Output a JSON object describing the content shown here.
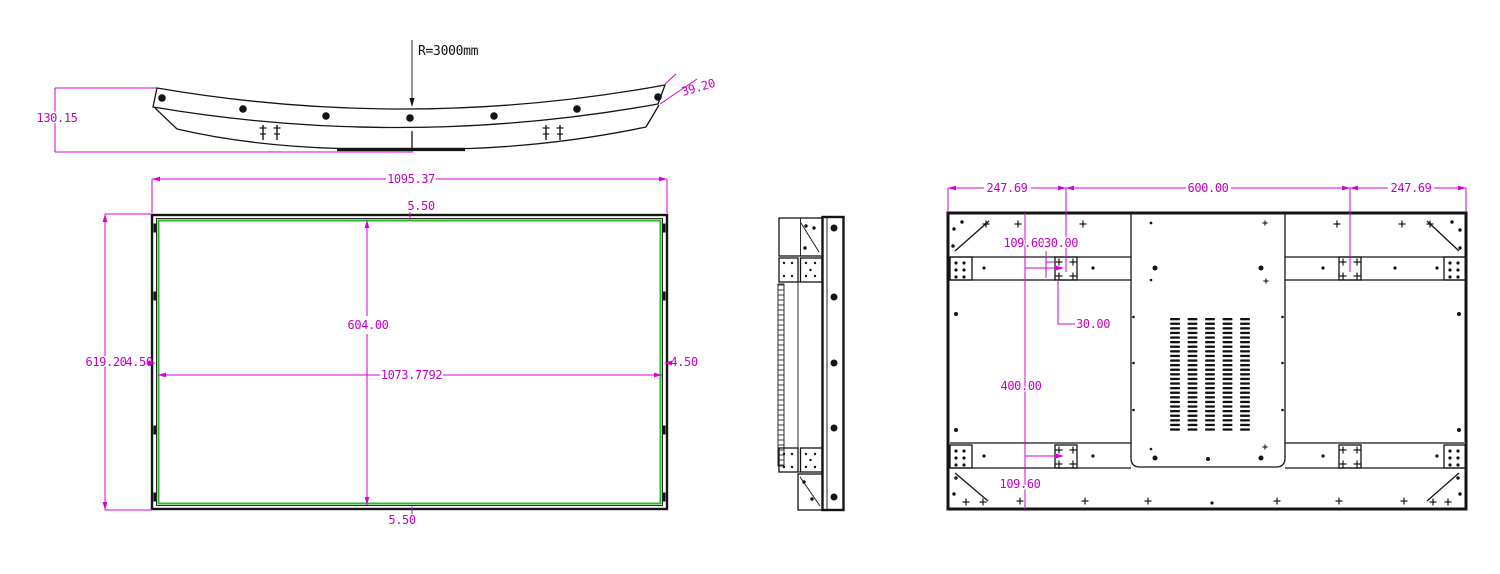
{
  "drawing_type": "display-panel-engineering-drawing",
  "colors": {
    "dimension": "#D400D4",
    "outline": "#141414",
    "screen_border": "#2FB52F",
    "background": "#ffffff"
  },
  "top_view": {
    "height_label": "130.15",
    "radius_label": "R=3000mm",
    "end_rise_label": "39.20"
  },
  "front_view": {
    "overall_width_label": "1095.37",
    "overall_height_label": "619.20",
    "top_frame_label": "5.50",
    "bottom_frame_label": "5.50",
    "left_frame_label": "4.50",
    "right_frame_label": "4.50",
    "inner_height_label": "604.00",
    "inner_width_label": "1073.7792"
  },
  "back_view": {
    "left_span_label": "247.69",
    "center_span_label": "600.00",
    "right_span_label": "247.69",
    "top_to_mount_label": "109.60",
    "mount_hole_h_label": "30.00",
    "mount_hole_v_label": "30.00",
    "mount_height_label": "400.00",
    "mount_to_bottom_label": "109.60"
  }
}
